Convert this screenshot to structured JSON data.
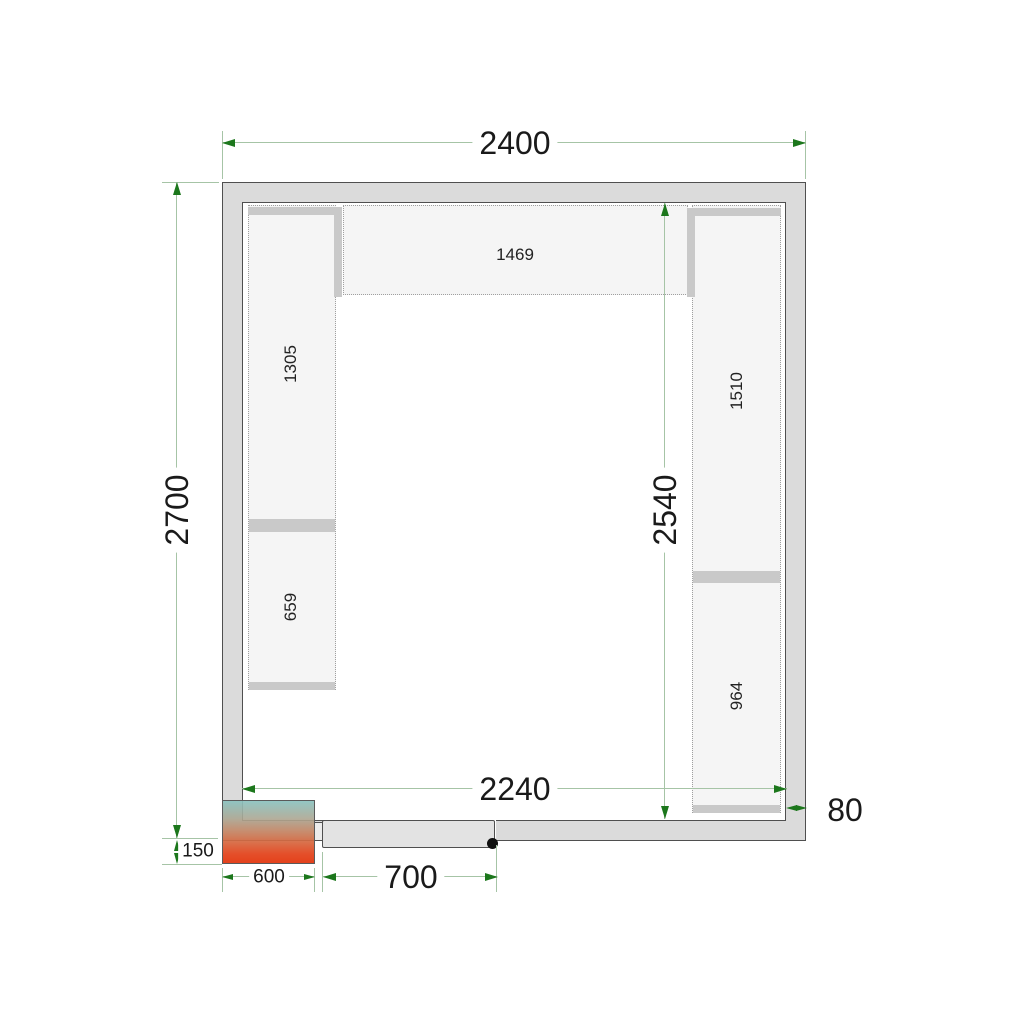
{
  "diagram": {
    "type": "cold-room floor plan, top view",
    "colors": {
      "wall_fill": "#dbdbdb",
      "wall_outline": "#4f4f4f",
      "shelf_fill": "#f5f5f5",
      "shelf_support_bar": "#c9c9c9",
      "dimension_line": "#a6c4a6",
      "dimension_arrow": "#1c771c",
      "unit_gradient_top": "#8ac2bf",
      "unit_gradient_bottom": "#e33a12",
      "hinge_dot": "#101010"
    }
  },
  "dimensions": {
    "outer_width": {
      "label": "2400"
    },
    "outer_height": {
      "label": "2700"
    },
    "inner_height": {
      "label": "2540"
    },
    "inner_width": {
      "label": "2240"
    },
    "wall_thickness": {
      "label": "80"
    },
    "unit_depth": {
      "label": "150"
    },
    "unit_width": {
      "label": "600"
    },
    "door_width": {
      "label": "700"
    }
  },
  "shelves": {
    "top": {
      "label": "1469"
    },
    "left_upper": {
      "label": "1305"
    },
    "left_lower": {
      "label": "659"
    },
    "right_upper": {
      "label": "1510"
    },
    "right_lower": {
      "label": "964"
    }
  }
}
